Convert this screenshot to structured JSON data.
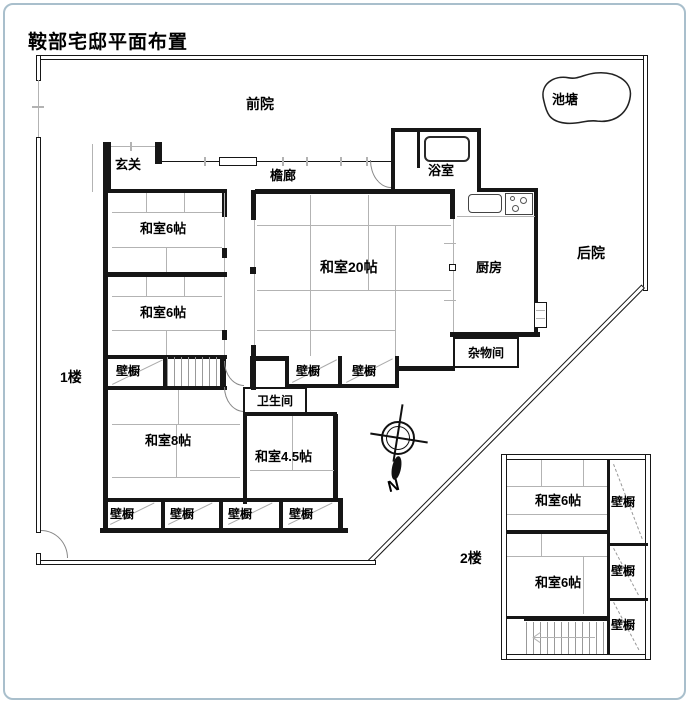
{
  "title": "鞍部宅邸平面布置",
  "site": {
    "front_yard": "前院",
    "pond": "池塘",
    "back_yard": "后院"
  },
  "compass": {
    "north": "N"
  },
  "floor1": {
    "label": "1楼",
    "genkan": "玄关",
    "engawa": "檐廊",
    "bathroom": "浴室",
    "washitsu6": "和室6帖",
    "washitsu20": "和室20帖",
    "kitchen": "厨房",
    "storage": "杂物间",
    "toilet": "卫生间",
    "washitsu8": "和室8帖",
    "washitsu45": "和室4.5帖",
    "closet": "壁橱"
  },
  "floor2": {
    "label": "2楼",
    "washitsu6": "和室6帖",
    "closet": "壁橱"
  }
}
